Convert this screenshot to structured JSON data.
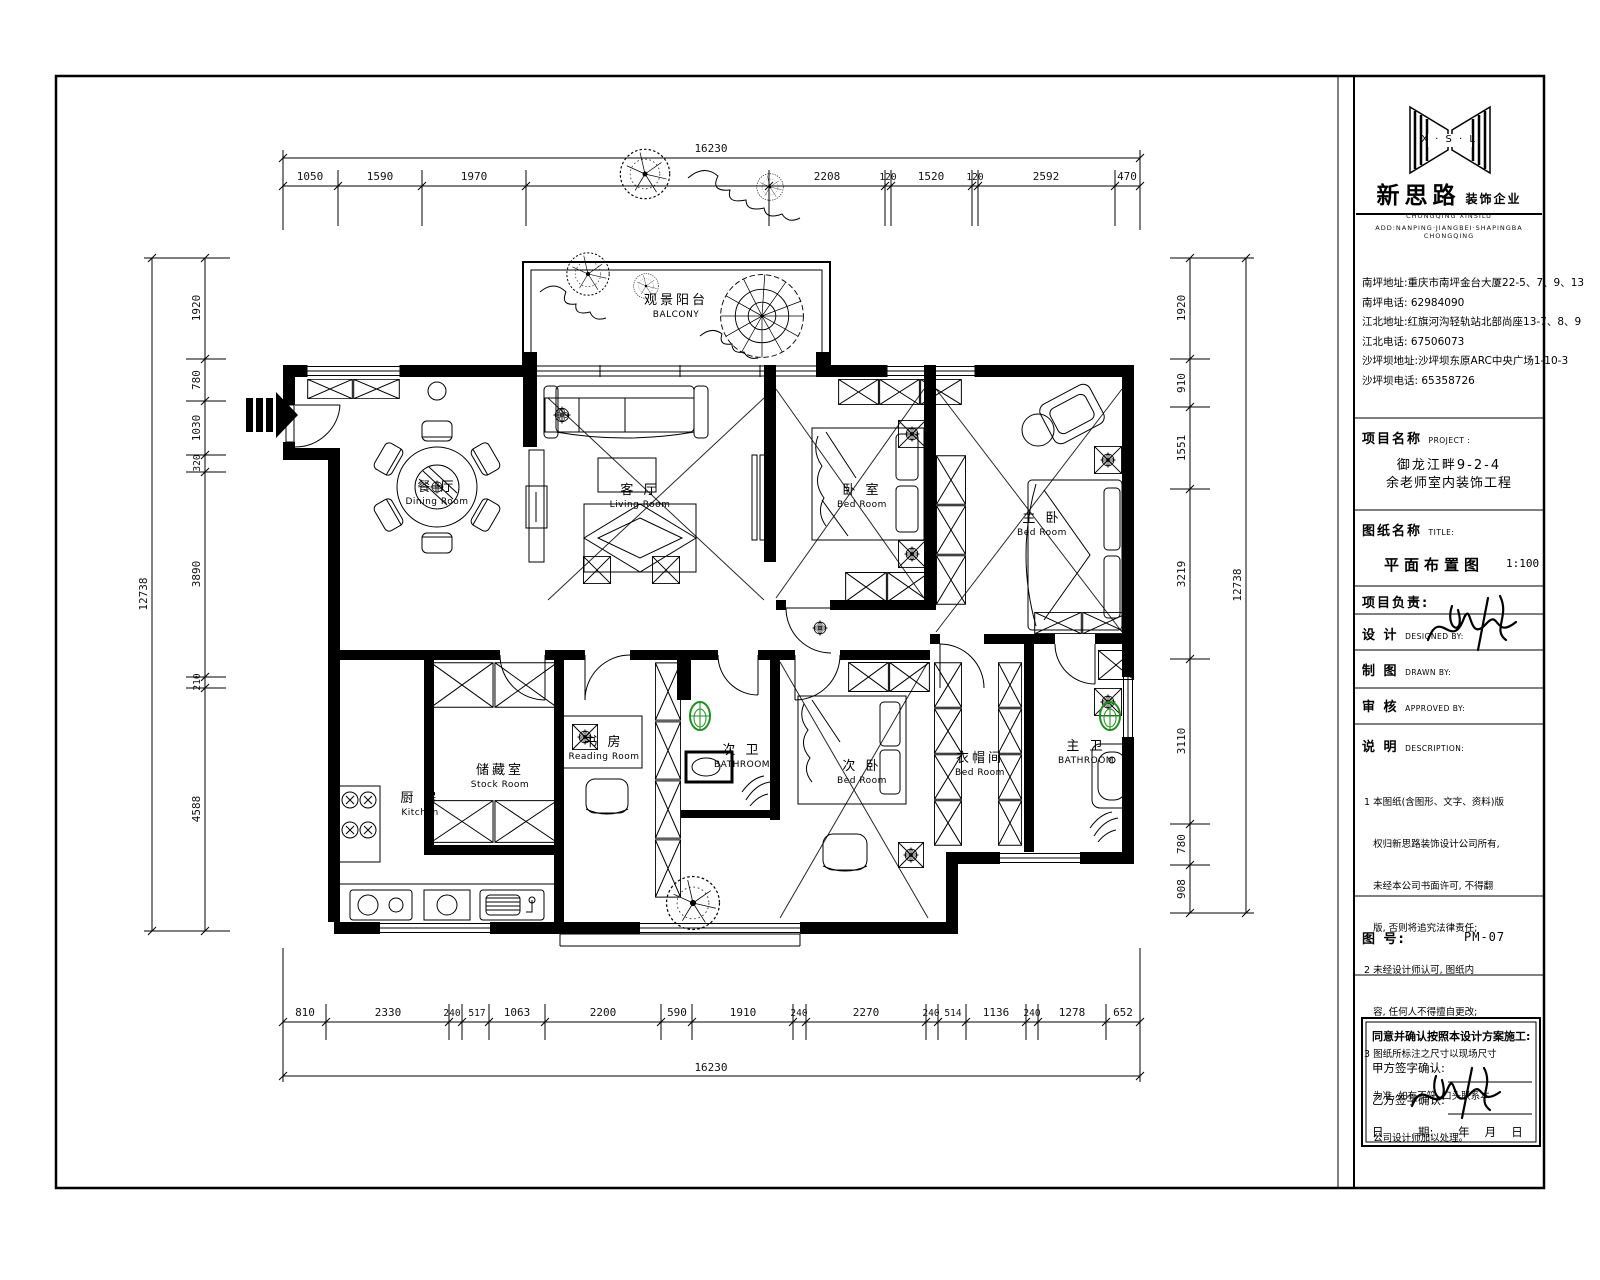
{
  "colors": {
    "line": "#000000",
    "toilet_green": "#1e8f1e",
    "paper": "#ffffff"
  },
  "title_block": {
    "logo": {
      "letters": "X · S · L",
      "company_zh": "新思路",
      "company_suffix": "装饰企业",
      "company_en1": "CHONGQING XINSILU",
      "company_en2": "ADD:NANPING·JIANGBEI·SHAPINGBA CHONGQING"
    },
    "addresses": [
      "南坪地址:重庆市南坪金台大厦22-5、7、9、13",
      "南坪电话: 62984090",
      "江北地址:红旗河沟轻轨站北部尚座13-7、8、9",
      "江北电话: 67506073",
      "沙坪坝地址:沙坪坝东原ARC中央广场1-10-3",
      "沙坪坝电话: 65358726"
    ],
    "project": {
      "label": "项目名称",
      "label_en": "PROJECT :",
      "line1": "御龙江畔9-2-4",
      "line2": "余老师室内装饰工程"
    },
    "sheet": {
      "label": "图纸名称",
      "label_en": "TITLE:",
      "name": "平面布置图",
      "scale": "1:100"
    },
    "roles": {
      "leader": "项目负责:",
      "design": "设  计",
      "design_en": "DESIGNED BY:",
      "draw": "制  图",
      "draw_en": "DRAWN BY:",
      "approve": "审  核",
      "approve_en": "APPROVED BY:"
    },
    "notes": {
      "label": "说  明",
      "label_en": "DESCRIPTION:",
      "lines": [
        "1 本图纸(含图形、文字、资料)版",
        "   权归新思路装饰设计公司所有,",
        "   未经本公司书面许可, 不得翻",
        "   版, 否则将追究法律责任;",
        "2 未经设计师认可, 图纸内",
        "   容, 任何人不得擅自更改;",
        "3 图纸所标注之尺寸以现场尺寸",
        "   为准, 如有不符, 口头联系本",
        "   公司设计师加以处理。"
      ]
    },
    "sheet_no": {
      "label": "图  号:",
      "value": "PM-07"
    },
    "confirm": {
      "line1": "同意并确认按照本设计方案施工:",
      "party_a": "甲方签字确认:",
      "party_b": "乙方签字确认:",
      "date_label": "日　　　期:",
      "date_value": "年　 月　 日"
    }
  },
  "plan": {
    "rooms": {
      "balcony": {
        "zh": "观景阳台",
        "en": "BALCONY"
      },
      "living": {
        "zh": "客 厅",
        "en": "Living Room"
      },
      "dining": {
        "zh": "餐 厅",
        "en": "Dining Room"
      },
      "bedroom1": {
        "zh": "卧 室",
        "en": "Bed Room"
      },
      "master": {
        "zh": "主 卧",
        "en": "Bed Room"
      },
      "reading": {
        "zh": "书 房",
        "en": "Reading Room"
      },
      "stock": {
        "zh": "储藏室",
        "en": "Stock Room"
      },
      "kitchen": {
        "zh": "厨 房",
        "en": "Kitchen"
      },
      "bath2": {
        "zh": "次 卫",
        "en": "BATHROOM"
      },
      "bedroom2": {
        "zh": "次 卧",
        "en": "Bed Room"
      },
      "cloak": {
        "zh": "衣帽间",
        "en": "Bed Room"
      },
      "bath1": {
        "zh": "主 卫",
        "en": "BATHROOM"
      }
    },
    "dims": {
      "top_total": "16230",
      "top": [
        "1050",
        "1590",
        "1970",
        "2208",
        "120",
        "1520",
        "120",
        "2592",
        "470"
      ],
      "bottom": [
        "810",
        "2330",
        "240",
        "517",
        "1063",
        "2200",
        "590",
        "1910",
        "240",
        "2270",
        "240",
        "514",
        "1136",
        "240",
        "1278",
        "652"
      ],
      "bottom_total": "16230",
      "left": [
        "1920",
        "780",
        "1030",
        "320",
        "3890",
        "210",
        "4588"
      ],
      "left_total": "12738",
      "right": [
        "1920",
        "910",
        "1551",
        "3219",
        "3110",
        "780",
        "908"
      ],
      "right_total": "12738"
    }
  }
}
